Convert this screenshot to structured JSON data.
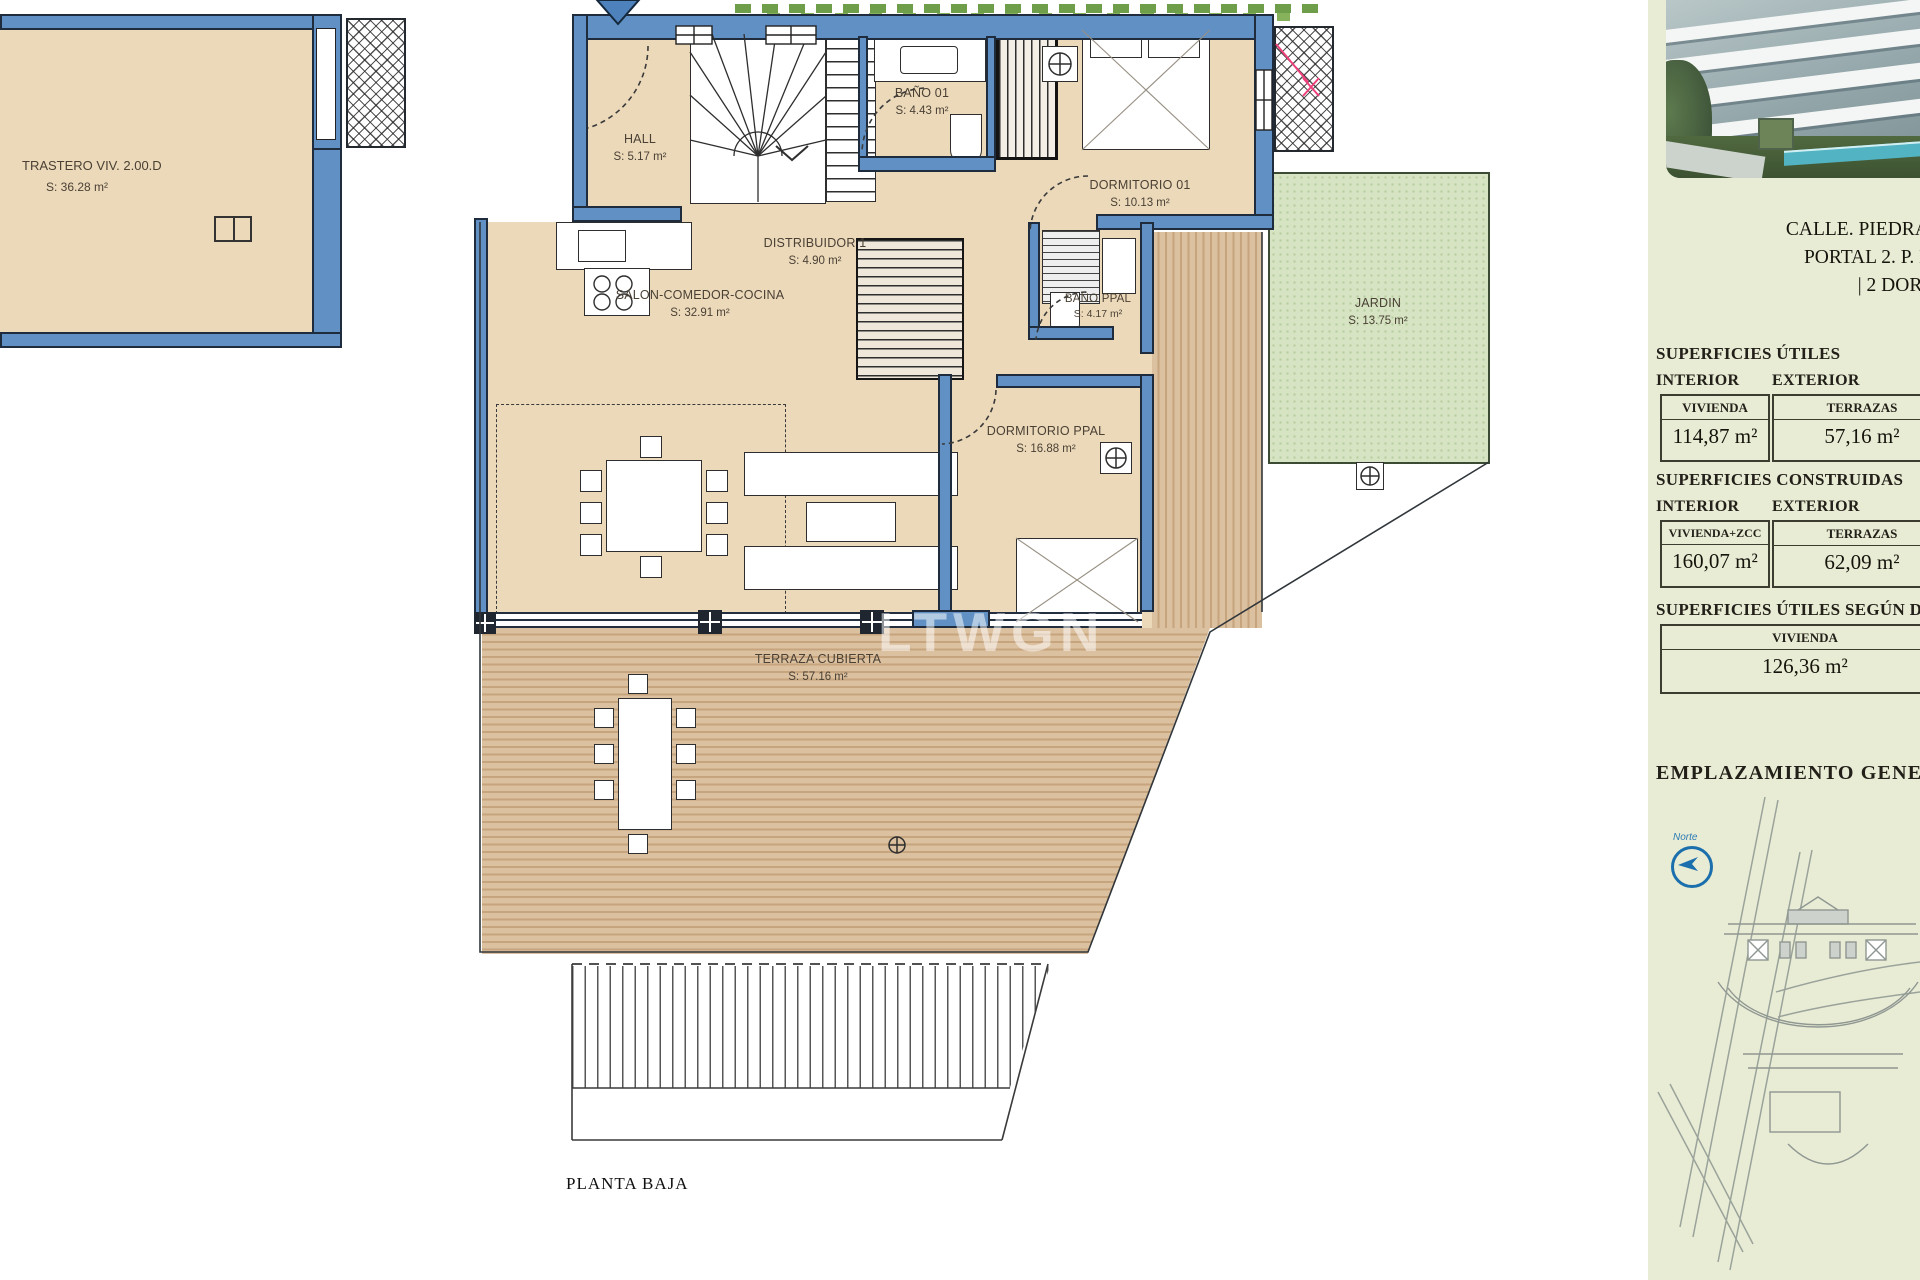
{
  "plan": {
    "floor_label": "PLANTA BAJA",
    "watermark": "LTWGN",
    "rooms": {
      "trastero": {
        "name": "TRASTERO VIV. 2.00.D",
        "area": "S:    36.28 m²"
      },
      "hall": {
        "name": "HALL",
        "area": "S:   5.17  m²"
      },
      "distribuidor": {
        "name": "DISTRIBUIDOR 1",
        "area": "S:   4.90  m²"
      },
      "bano1": {
        "name": "BAÑO 01",
        "area": "S:  4.43  m²"
      },
      "dormitorio1": {
        "name": "DORMITORIO 01",
        "area": "S: 10.13  m²"
      },
      "salon": {
        "name": "SALON-COMEDOR-COCINA",
        "area": "S:   32.91 m²"
      },
      "banoppal": {
        "name": "BAÑO PPAL",
        "area": "S: 4.17 m²"
      },
      "dormppal": {
        "name": "DORMITORIO PPAL",
        "area": "S:   16.88 m²"
      },
      "jardin": {
        "name": "JARDIN",
        "area": "S:   13.75 m²"
      },
      "terraza": {
        "name": "TERRAZA CUBIERTA",
        "area": "S:   57.16 m²"
      }
    }
  },
  "sidebar": {
    "address_line1": "CALLE. PIEDRA PALOMA,",
    "address_line2": "PORTAL 2. P. BAJA Y S",
    "address_line3": "| 2 DORMI",
    "superficies_utiles": {
      "title": "SUPERFICIES ÚTILES",
      "interior_label": "INTERIOR",
      "exterior_label": "EXTERIOR",
      "interior_box_label": "VIVIENDA",
      "interior_box_value": "114,87 m²",
      "exterior_box_label": "TERRAZAS",
      "exterior_box_value": "57,16 m²"
    },
    "superficies_construidas": {
      "title": "SUPERFICIES CONSTRUIDAS",
      "interior_label": "INTERIOR",
      "exterior_label": "EXTERIOR",
      "interior_box_label": "VIVIENDA+ZCC",
      "interior_box_value": "160,07 m²",
      "exterior_box_label": "TERRAZAS",
      "exterior_box_value": "62,09 m²"
    },
    "superficies_decreto": {
      "title": "SUPERFICIES ÚTILES SEGÚN DECR",
      "box_label": "VIVIENDA",
      "box_value": "126,36 m²"
    },
    "emplazamiento_title": "EMPLAZAMIENTO GENERAL",
    "compass_label": "Norte"
  },
  "colors": {
    "wall_blue": "#6191c4",
    "floor_beige": "#ebd9ba",
    "deck_wood": "#d7bb97",
    "garden_green": "#d6e4c3",
    "panel_background": "#e9ecd4",
    "compass_blue": "#1b6fad",
    "marker_pink": "#ef3f7d"
  }
}
